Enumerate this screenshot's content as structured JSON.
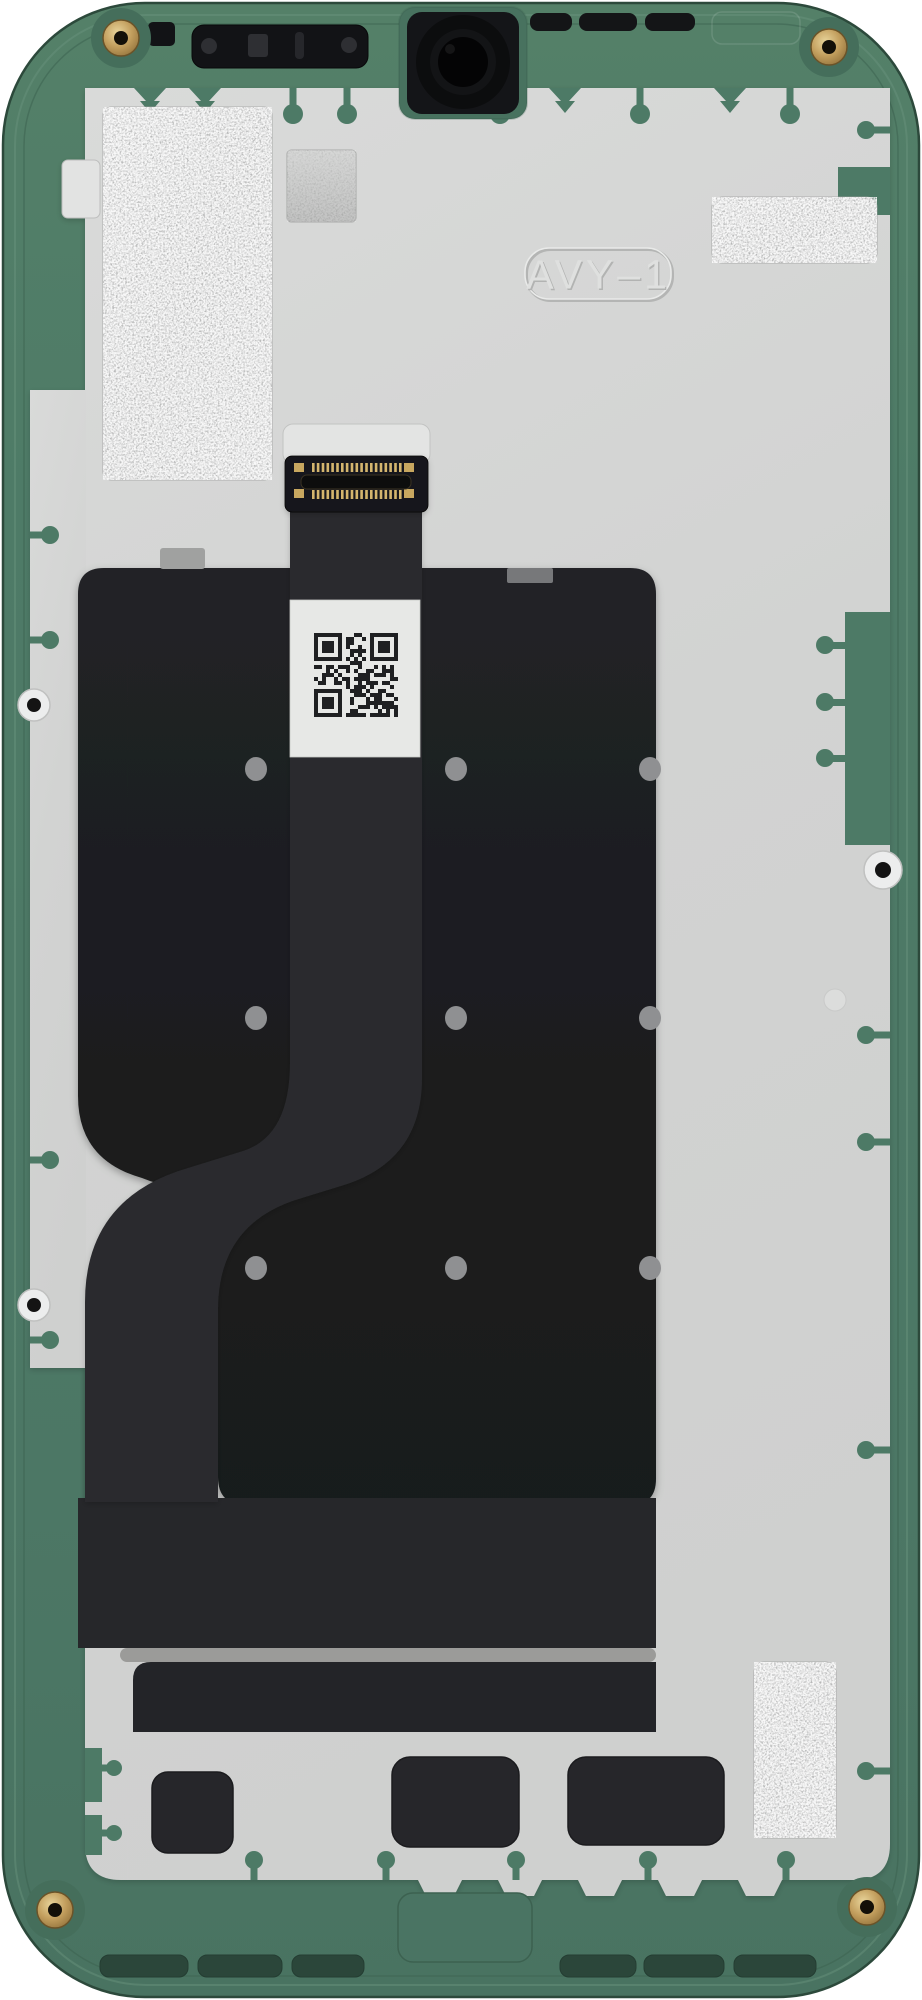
{
  "scene": {
    "description": "Rear view of a disassembled smartphone display mid-frame assembly",
    "emboss": {
      "text": "AVY–1"
    }
  },
  "qr": {
    "modules": 21,
    "seed": 9,
    "module_px": 4,
    "x": 314,
    "y": 633,
    "dark": "#1f2022"
  },
  "dots": {
    "columns": [
      256,
      456,
      650
    ],
    "rows": [
      769,
      1018,
      1268
    ],
    "rx": 11,
    "ry": 12,
    "color": "#8f9092"
  },
  "connector": {
    "pins_per_row": 19,
    "rows_y": [
      463,
      490
    ],
    "x_start": 312,
    "x_end": 399,
    "pin_w": 2.6,
    "pin_h": 9,
    "pin_color": "#d4b56e"
  },
  "colors": {
    "frame_green": "#4d7a66",
    "frame_green_dark": "#35594a",
    "plate_gray": "#d4d5d4",
    "graphite_black": "#1c1d1f",
    "ribbon_black": "#2a2b2e",
    "foil_silver": "#bcbdbc",
    "brass_screw": "#c29e5d",
    "qr_label_white": "#e7e8e6",
    "bottom_band_gray": "#9b9b99"
  },
  "counts": {
    "corner_screws": 4,
    "thermal_foil_patches": 3,
    "bottom_cutouts": 3,
    "speaker_vent_slots": 6
  }
}
